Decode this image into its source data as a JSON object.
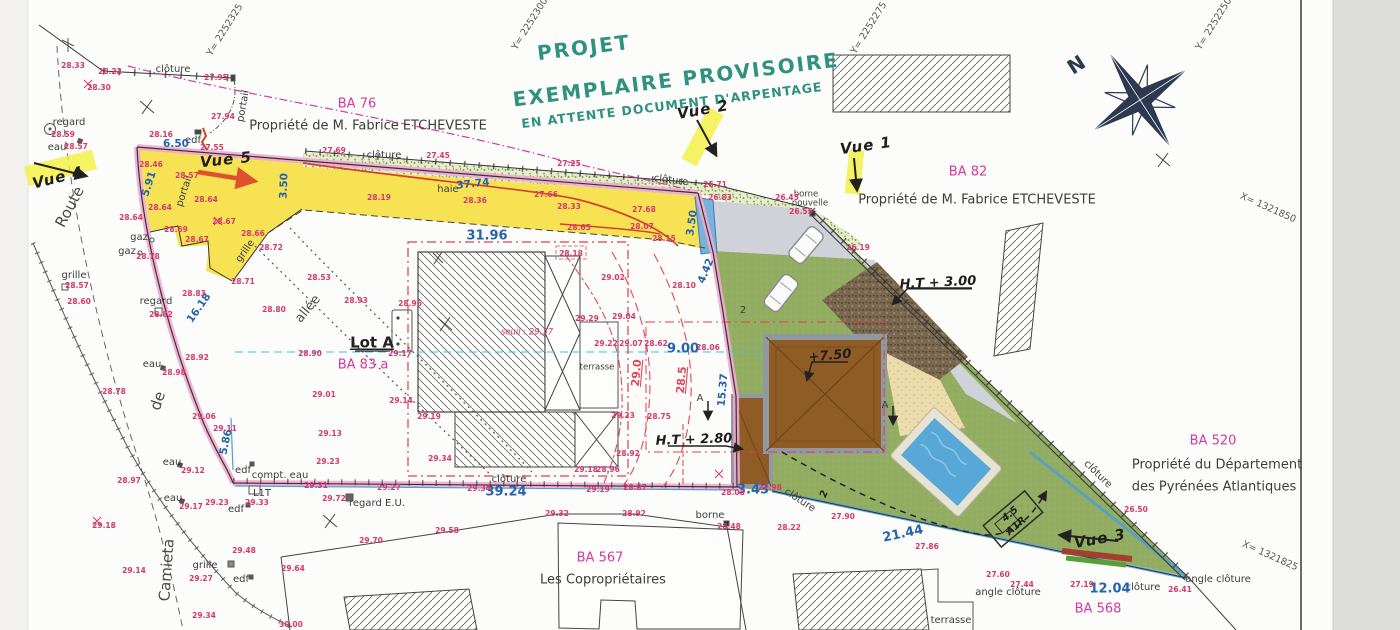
{
  "title": {
    "line1": "PROJET",
    "line2": "EXEMPLAIRE PROVISOIRE",
    "line3": "EN ATTENTE DOCUMENT D'ARPENTAGE"
  },
  "colors": {
    "title_green": "#2f9180",
    "parcel_pink": "#d5399c",
    "measure_blue": "#2563ae",
    "elevation_red": "#d5386e",
    "boundary_pink": "#f2a9d2",
    "parcel_yellow": "#f5e049",
    "lawn_green": "#93ad62",
    "pool_blue": "#57a8d6",
    "roof_brown": "#8f5c26",
    "highlight_yellow": "#f2ef3f"
  },
  "parcels": [
    {
      "id": "BA 76",
      "owner": "Propriété de M. Fabrice ETCHEVESTE"
    },
    {
      "id": "BA 82",
      "owner": "Propriété de M. Fabrice ETCHEVESTE"
    },
    {
      "id": "BA 520",
      "owner": "Propriété du Département des Pyrénées Atlantiques"
    },
    {
      "id": "BA 567",
      "owner": "Les Copropriétaires"
    },
    {
      "id": "BA 568",
      "owner": ""
    },
    {
      "id": "BA 83 a",
      "owner": "Lot A"
    }
  ],
  "labels": [
    {
      "t": "Y= 2252325",
      "x": 225,
      "y": 30,
      "r": -58,
      "c": "coord"
    },
    {
      "t": "Y= 2252300",
      "x": 530,
      "y": 24,
      "r": -58,
      "c": "coord"
    },
    {
      "t": "Y= 2252275",
      "x": 869,
      "y": 28,
      "r": -58,
      "c": "coord"
    },
    {
      "t": "Y= 2252250",
      "x": 1214,
      "y": 24,
      "r": -58,
      "c": "coord"
    },
    {
      "t": "X= 1321850",
      "x": 1268,
      "y": 208,
      "r": 24,
      "c": "coord"
    },
    {
      "t": "X= 1321825",
      "x": 1270,
      "y": 556,
      "r": 24,
      "c": "coord"
    },
    {
      "t": "BA 76",
      "x": 357,
      "y": 104,
      "c": "pink"
    },
    {
      "t": "Propriété de M. Fabrice ETCHEVESTE",
      "x": 368,
      "y": 126,
      "c": "own"
    },
    {
      "t": "BA 82",
      "x": 968,
      "y": 172,
      "c": "pink"
    },
    {
      "t": "Propriété de M. Fabrice ETCHEVESTE",
      "x": 977,
      "y": 200,
      "c": "own"
    },
    {
      "t": "BA 520",
      "x": 1213,
      "y": 441,
      "c": "pink"
    },
    {
      "t": "Propriété du Département",
      "x": 1217,
      "y": 465,
      "c": "own"
    },
    {
      "t": "des Pyrénées Atlantiques",
      "x": 1214,
      "y": 487,
      "c": "own"
    },
    {
      "t": "BA 567",
      "x": 600,
      "y": 558,
      "c": "pink"
    },
    {
      "t": "Les Copropriétaires",
      "x": 603,
      "y": 580,
      "c": "own"
    },
    {
      "t": "BA 568",
      "x": 1098,
      "y": 609,
      "c": "pink"
    },
    {
      "t": "BA 83 a",
      "x": 363,
      "y": 365,
      "c": "pink"
    },
    {
      "t": "Lot A",
      "x": 372,
      "y": 343,
      "c": "lot"
    },
    {
      "t": "Vue 2",
      "x": 703,
      "y": 110,
      "r": -10,
      "c": "hand"
    },
    {
      "t": "Vue 1",
      "x": 866,
      "y": 146,
      "r": -8,
      "c": "hand"
    },
    {
      "t": "Vue 4",
      "x": 58,
      "y": 178,
      "r": -14,
      "c": "hand"
    },
    {
      "t": "Vue 5",
      "x": 226,
      "y": 160,
      "r": -6,
      "c": "hand"
    },
    {
      "t": "Vue 3",
      "x": 1100,
      "y": 539,
      "r": -10,
      "c": "hand"
    },
    {
      "t": "H.T + 3.00",
      "x": 938,
      "y": 283,
      "r": -3,
      "c": "hand2"
    },
    {
      "t": "H.T + 2.80",
      "x": 694,
      "y": 440,
      "r": -2,
      "c": "hand2"
    },
    {
      "t": "+7.50",
      "x": 830,
      "y": 356,
      "r": -5,
      "c": "hand2"
    },
    {
      "t": "4.5",
      "x": 1010,
      "y": 514,
      "r": -40,
      "c": "hand3"
    },
    {
      "t": "A1R",
      "x": 1016,
      "y": 526,
      "r": -40,
      "c": "hand3"
    },
    {
      "t": "2",
      "x": 743,
      "y": 310,
      "c": "blk"
    },
    {
      "t": "2",
      "x": 824,
      "y": 494,
      "r": -70,
      "c": "hand3"
    },
    {
      "t": "N",
      "x": 1077,
      "y": 66,
      "r": -33,
      "c": "north"
    },
    {
      "t": "A",
      "x": 700,
      "y": 398,
      "c": "blk"
    },
    {
      "t": "A",
      "x": 885,
      "y": 405,
      "c": "blk"
    },
    {
      "t": "Route",
      "x": 70,
      "y": 207,
      "r": -62,
      "c": "street"
    },
    {
      "t": "de",
      "x": 158,
      "y": 401,
      "r": -72,
      "c": "street"
    },
    {
      "t": "Camieta",
      "x": 167,
      "y": 570,
      "r": -86,
      "c": "street"
    },
    {
      "t": "allée",
      "x": 308,
      "y": 309,
      "r": -50,
      "c": "street2"
    },
    {
      "t": "clôture",
      "x": 173,
      "y": 69,
      "c": "blk"
    },
    {
      "t": "clôture",
      "x": 384,
      "y": 155,
      "c": "blk"
    },
    {
      "t": "clôture",
      "x": 671,
      "y": 180,
      "r": 7,
      "c": "blk"
    },
    {
      "t": "clôture",
      "x": 509,
      "y": 479,
      "c": "blk"
    },
    {
      "t": "clôture",
      "x": 800,
      "y": 500,
      "r": 33,
      "c": "blk"
    },
    {
      "t": "clôture",
      "x": 1098,
      "y": 474,
      "r": 44,
      "c": "blk"
    },
    {
      "t": "clôture",
      "x": 1143,
      "y": 587,
      "c": "blk"
    },
    {
      "t": "haie",
      "x": 448,
      "y": 189,
      "c": "blk"
    },
    {
      "t": "portail",
      "x": 243,
      "y": 106,
      "r": -80,
      "c": "blk"
    },
    {
      "t": "portail",
      "x": 184,
      "y": 191,
      "r": -72,
      "c": "blk"
    },
    {
      "t": "grille",
      "x": 245,
      "y": 251,
      "r": -55,
      "c": "blk"
    },
    {
      "t": "grille",
      "x": 74,
      "y": 275,
      "c": "blk"
    },
    {
      "t": "grille",
      "x": 205,
      "y": 565,
      "c": "blk"
    },
    {
      "t": "regard",
      "x": 69,
      "y": 122,
      "c": "blk"
    },
    {
      "t": "regard",
      "x": 156,
      "y": 301,
      "c": "blk"
    },
    {
      "t": "regard E.U.",
      "x": 377,
      "y": 503,
      "c": "blk"
    },
    {
      "t": "eau",
      "x": 57,
      "y": 147,
      "c": "blk"
    },
    {
      "t": "eau",
      "x": 152,
      "y": 364,
      "c": "blk"
    },
    {
      "t": "eau",
      "x": 172,
      "y": 462,
      "c": "blk"
    },
    {
      "t": "eau",
      "x": 173,
      "y": 498,
      "c": "blk"
    },
    {
      "t": "edf",
      "x": 193,
      "y": 140,
      "c": "blk"
    },
    {
      "t": "edf",
      "x": 243,
      "y": 470,
      "c": "blk"
    },
    {
      "t": "edf",
      "x": 236,
      "y": 509,
      "c": "blk"
    },
    {
      "t": "edf",
      "x": 241,
      "y": 579,
      "c": "blk"
    },
    {
      "t": "gaz",
      "x": 139,
      "y": 237,
      "c": "blk"
    },
    {
      "t": "gaz",
      "x": 127,
      "y": 251,
      "c": "blk"
    },
    {
      "t": "compt. eau",
      "x": 280,
      "y": 475,
      "c": "blk"
    },
    {
      "t": "L1T",
      "x": 262,
      "y": 493,
      "c": "blk"
    },
    {
      "t": "borne",
      "x": 710,
      "y": 515,
      "c": "blk"
    },
    {
      "t": "borne",
      "x": 806,
      "y": 194,
      "c": "blk-sm"
    },
    {
      "t": "nouvelle",
      "x": 810,
      "y": 203,
      "c": "blk-sm"
    },
    {
      "t": "terrasse",
      "x": 597,
      "y": 367,
      "c": "blk-sm"
    },
    {
      "t": "terrasse",
      "x": 951,
      "y": 620,
      "c": "blk"
    },
    {
      "t": "angle clôture",
      "x": 1008,
      "y": 592,
      "c": "blk"
    },
    {
      "t": "angle clôture",
      "x": 1218,
      "y": 579,
      "c": "blk"
    },
    {
      "t": "6.50",
      "x": 176,
      "y": 144,
      "c": "blue"
    },
    {
      "t": "5.91",
      "x": 149,
      "y": 184,
      "r": -72,
      "c": "blue"
    },
    {
      "t": "3.50",
      "x": 284,
      "y": 186,
      "r": -88,
      "c": "blue"
    },
    {
      "t": "37.74",
      "x": 473,
      "y": 184,
      "r": -6,
      "c": "blue"
    },
    {
      "t": "31.96",
      "x": 487,
      "y": 236,
      "c": "blue-lg"
    },
    {
      "t": "3.50",
      "x": 692,
      "y": 223,
      "r": -82,
      "c": "blue"
    },
    {
      "t": "4.42",
      "x": 706,
      "y": 271,
      "r": -68,
      "c": "blue"
    },
    {
      "t": "9.00",
      "x": 683,
      "y": 349,
      "c": "blue-lg"
    },
    {
      "t": "15.37",
      "x": 723,
      "y": 390,
      "r": -85,
      "c": "blue"
    },
    {
      "t": "5.86",
      "x": 226,
      "y": 442,
      "r": -78,
      "c": "blue"
    },
    {
      "t": "16.18",
      "x": 199,
      "y": 308,
      "r": -55,
      "c": "blue"
    },
    {
      "t": "39.24",
      "x": 506,
      "y": 492,
      "c": "blue-lg"
    },
    {
      "t": "3.43",
      "x": 753,
      "y": 490,
      "c": "blue-lg"
    },
    {
      "t": "21.44",
      "x": 903,
      "y": 534,
      "r": -12,
      "c": "blue-lg"
    },
    {
      "t": "12.04",
      "x": 1110,
      "y": 589,
      "c": "blue-lg"
    },
    {
      "t": "29.0",
      "x": 637,
      "y": 373,
      "r": -85,
      "c": "red-dim"
    },
    {
      "t": "28.5",
      "x": 682,
      "y": 380,
      "r": -85,
      "c": "red-dim"
    },
    {
      "t": "seuil : 29.37",
      "x": 527,
      "y": 332,
      "c": "seuil"
    },
    {
      "t": "28.33",
      "x": 73,
      "y": 66,
      "c": "elev"
    },
    {
      "t": "28.22",
      "x": 110,
      "y": 72,
      "c": "elev"
    },
    {
      "t": "28.30",
      "x": 99,
      "y": 88,
      "c": "elev"
    },
    {
      "t": "27.95",
      "x": 216,
      "y": 78,
      "c": "elev"
    },
    {
      "t": "27.94",
      "x": 223,
      "y": 117,
      "c": "elev"
    },
    {
      "t": "28.59",
      "x": 63,
      "y": 135,
      "c": "elev"
    },
    {
      "t": "28.57",
      "x": 76,
      "y": 147,
      "c": "elev"
    },
    {
      "t": "28.16",
      "x": 161,
      "y": 135,
      "c": "elev"
    },
    {
      "t": "27.55",
      "x": 212,
      "y": 148,
      "c": "elev"
    },
    {
      "t": "28.46",
      "x": 151,
      "y": 165,
      "c": "elev"
    },
    {
      "t": "28.57",
      "x": 187,
      "y": 176,
      "c": "elev"
    },
    {
      "t": "28.64",
      "x": 206,
      "y": 200,
      "c": "elev"
    },
    {
      "t": "28.64",
      "x": 160,
      "y": 208,
      "c": "elev"
    },
    {
      "t": "28.64",
      "x": 131,
      "y": 218,
      "c": "elev"
    },
    {
      "t": "28.69",
      "x": 176,
      "y": 230,
      "c": "elev"
    },
    {
      "t": "28.67",
      "x": 197,
      "y": 240,
      "c": "elev"
    },
    {
      "t": "28.67",
      "x": 224,
      "y": 222,
      "c": "elev"
    },
    {
      "t": "28.66",
      "x": 253,
      "y": 234,
      "c": "elev"
    },
    {
      "t": "28.72",
      "x": 271,
      "y": 248,
      "c": "elev"
    },
    {
      "t": "28.71",
      "x": 243,
      "y": 282,
      "c": "elev"
    },
    {
      "t": "28.78",
      "x": 148,
      "y": 257,
      "c": "elev"
    },
    {
      "t": "28.83",
      "x": 194,
      "y": 294,
      "c": "elev"
    },
    {
      "t": "28.82",
      "x": 161,
      "y": 315,
      "c": "elev"
    },
    {
      "t": "28.53",
      "x": 319,
      "y": 278,
      "c": "elev"
    },
    {
      "t": "28.93",
      "x": 356,
      "y": 301,
      "c": "elev"
    },
    {
      "t": "28.80",
      "x": 274,
      "y": 310,
      "c": "elev"
    },
    {
      "t": "27.69",
      "x": 334,
      "y": 151,
      "c": "elev"
    },
    {
      "t": "27.45",
      "x": 438,
      "y": 156,
      "c": "elev"
    },
    {
      "t": "27.25",
      "x": 569,
      "y": 164,
      "c": "elev"
    },
    {
      "t": "28.19",
      "x": 379,
      "y": 198,
      "c": "elev"
    },
    {
      "t": "28.36",
      "x": 475,
      "y": 201,
      "c": "elev"
    },
    {
      "t": "27.66",
      "x": 546,
      "y": 195,
      "c": "elev"
    },
    {
      "t": "28.33",
      "x": 569,
      "y": 207,
      "c": "elev"
    },
    {
      "t": "27.68",
      "x": 644,
      "y": 210,
      "c": "elev"
    },
    {
      "t": "28.65",
      "x": 579,
      "y": 228,
      "c": "elev"
    },
    {
      "t": "28.07",
      "x": 642,
      "y": 227,
      "c": "elev"
    },
    {
      "t": "28.15",
      "x": 664,
      "y": 239,
      "c": "elev"
    },
    {
      "t": "26.71",
      "x": 715,
      "y": 185,
      "c": "elev"
    },
    {
      "t": "26.83",
      "x": 720,
      "y": 198,
      "c": "elev"
    },
    {
      "t": "26.45",
      "x": 787,
      "y": 198,
      "c": "elev"
    },
    {
      "t": "26.55",
      "x": 801,
      "y": 212,
      "c": "elev"
    },
    {
      "t": "26.19",
      "x": 858,
      "y": 248,
      "c": "elev"
    },
    {
      "t": "28.18",
      "x": 571,
      "y": 254,
      "c": "elev"
    },
    {
      "t": "29.02",
      "x": 613,
      "y": 278,
      "c": "elev"
    },
    {
      "t": "28.10",
      "x": 684,
      "y": 286,
      "c": "elev"
    },
    {
      "t": "29.29",
      "x": 587,
      "y": 319,
      "c": "elev"
    },
    {
      "t": "29.04",
      "x": 624,
      "y": 317,
      "c": "elev"
    },
    {
      "t": "29.22",
      "x": 606,
      "y": 344,
      "c": "elev"
    },
    {
      "t": "29.07",
      "x": 631,
      "y": 344,
      "c": "elev"
    },
    {
      "t": "28.62",
      "x": 656,
      "y": 344,
      "c": "elev"
    },
    {
      "t": "28.06",
      "x": 708,
      "y": 348,
      "c": "elev"
    },
    {
      "t": "28.96",
      "x": 410,
      "y": 304,
      "c": "elev"
    },
    {
      "t": "29.17",
      "x": 400,
      "y": 354,
      "c": "elev"
    },
    {
      "t": "29.14",
      "x": 401,
      "y": 401,
      "c": "elev"
    },
    {
      "t": "29.19",
      "x": 429,
      "y": 417,
      "c": "elev"
    },
    {
      "t": "29.34",
      "x": 440,
      "y": 459,
      "c": "elev"
    },
    {
      "t": "28.75",
      "x": 659,
      "y": 417,
      "c": "elev"
    },
    {
      "t": "29.23",
      "x": 623,
      "y": 416,
      "c": "elev"
    },
    {
      "t": "28.92",
      "x": 628,
      "y": 454,
      "c": "elev"
    },
    {
      "t": "29.18",
      "x": 586,
      "y": 470,
      "c": "elev"
    },
    {
      "t": "28.96",
      "x": 608,
      "y": 470,
      "c": "elev"
    },
    {
      "t": "29.27",
      "x": 389,
      "y": 488,
      "c": "elev"
    },
    {
      "t": "29.34",
      "x": 479,
      "y": 489,
      "c": "elev"
    },
    {
      "t": "29.19",
      "x": 598,
      "y": 490,
      "c": "elev"
    },
    {
      "t": "28.87",
      "x": 635,
      "y": 488,
      "c": "elev"
    },
    {
      "t": "28.08",
      "x": 733,
      "y": 493,
      "c": "elev"
    },
    {
      "t": "27.98",
      "x": 770,
      "y": 488,
      "c": "elev"
    },
    {
      "t": "28.92",
      "x": 197,
      "y": 358,
      "c": "elev"
    },
    {
      "t": "28.98",
      "x": 174,
      "y": 373,
      "c": "elev"
    },
    {
      "t": "28.78",
      "x": 114,
      "y": 392,
      "c": "elev"
    },
    {
      "t": "29.06",
      "x": 204,
      "y": 417,
      "c": "elev"
    },
    {
      "t": "29.11",
      "x": 225,
      "y": 429,
      "c": "elev"
    },
    {
      "t": "29.12",
      "x": 193,
      "y": 471,
      "c": "elev"
    },
    {
      "t": "28.97",
      "x": 129,
      "y": 481,
      "c": "elev"
    },
    {
      "t": "29.17",
      "x": 191,
      "y": 507,
      "c": "elev"
    },
    {
      "t": "29.23",
      "x": 217,
      "y": 503,
      "c": "elev"
    },
    {
      "t": "29.33",
      "x": 257,
      "y": 503,
      "c": "elev"
    },
    {
      "t": "29.31",
      "x": 316,
      "y": 486,
      "c": "elev"
    },
    {
      "t": "29.72",
      "x": 334,
      "y": 499,
      "c": "elev"
    },
    {
      "t": "29.18",
      "x": 104,
      "y": 526,
      "c": "elev"
    },
    {
      "t": "28.90",
      "x": 310,
      "y": 354,
      "c": "elev"
    },
    {
      "t": "29.01",
      "x": 324,
      "y": 395,
      "c": "elev"
    },
    {
      "t": "29.13",
      "x": 330,
      "y": 434,
      "c": "elev"
    },
    {
      "t": "29.23",
      "x": 328,
      "y": 462,
      "c": "elev"
    },
    {
      "t": "29.14",
      "x": 134,
      "y": 571,
      "c": "elev"
    },
    {
      "t": "29.27",
      "x": 201,
      "y": 579,
      "c": "elev"
    },
    {
      "t": "29.48",
      "x": 244,
      "y": 551,
      "c": "elev"
    },
    {
      "t": "29.64",
      "x": 293,
      "y": 569,
      "c": "elev"
    },
    {
      "t": "29.34",
      "x": 204,
      "y": 616,
      "c": "elev"
    },
    {
      "t": "30.00",
      "x": 291,
      "y": 625,
      "c": "elev"
    },
    {
      "t": "28.57",
      "x": 77,
      "y": 286,
      "c": "elev"
    },
    {
      "t": "28.60",
      "x": 79,
      "y": 302,
      "c": "elev"
    },
    {
      "t": "29.32",
      "x": 557,
      "y": 514,
      "c": "elev"
    },
    {
      "t": "28.92",
      "x": 634,
      "y": 514,
      "c": "elev"
    },
    {
      "t": "28.48",
      "x": 729,
      "y": 527,
      "c": "elev"
    },
    {
      "t": "29.58",
      "x": 447,
      "y": 531,
      "c": "elev"
    },
    {
      "t": "29.70",
      "x": 371,
      "y": 541,
      "c": "elev"
    },
    {
      "t": "28.22",
      "x": 789,
      "y": 528,
      "c": "elev"
    },
    {
      "t": "27.90",
      "x": 843,
      "y": 517,
      "c": "elev"
    },
    {
      "t": "27.86",
      "x": 927,
      "y": 547,
      "c": "elev"
    },
    {
      "t": "27.60",
      "x": 998,
      "y": 575,
      "c": "elev"
    },
    {
      "t": "27.44",
      "x": 1022,
      "y": 585,
      "c": "elev"
    },
    {
      "t": "27.19",
      "x": 1082,
      "y": 585,
      "c": "elev"
    },
    {
      "t": "26.41",
      "x": 1180,
      "y": 590,
      "c": "elev"
    },
    {
      "t": "26.50",
      "x": 1136,
      "y": 510,
      "c": "elev"
    }
  ]
}
